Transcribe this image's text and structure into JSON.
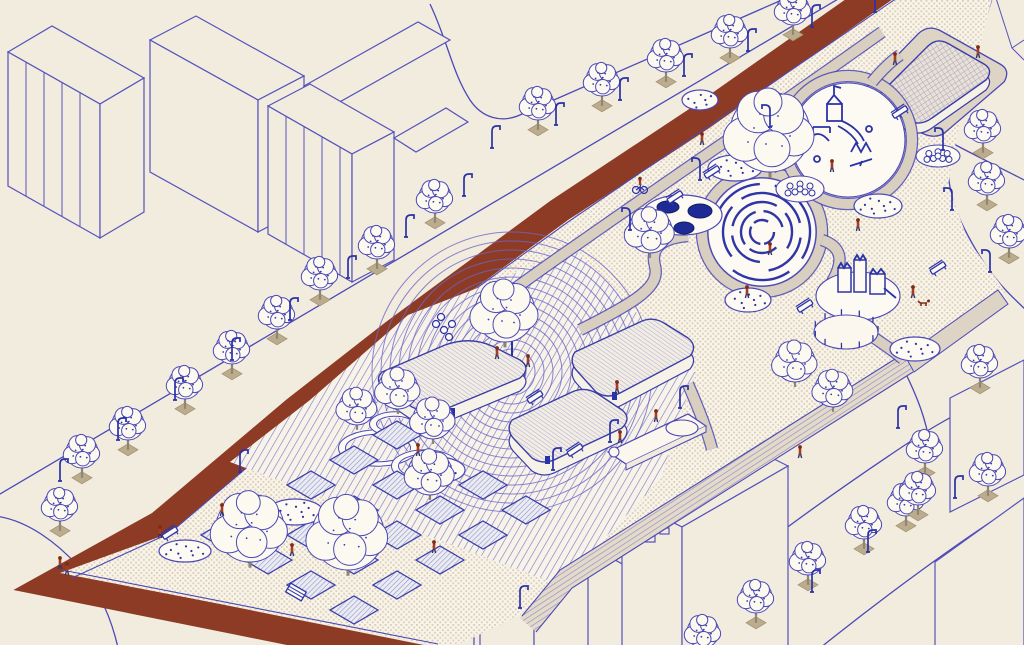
{
  "palette": {
    "background": "#f2ecdf",
    "park_ground": "#f9f4e9",
    "ground_dot": "#d9ccb6",
    "line_blue": "#4c49b6",
    "detail_navy": "#2a32a8",
    "pond_navy": "#1e2a96",
    "road_red": "#8e3b26",
    "path_tan": "#d9cfc0",
    "platform_tan": "#ded4c5",
    "person_red": "#a63c21",
    "person_head": "#7c2d16",
    "person_legs": "#2f3366",
    "tree_pit": "#bcac8e",
    "trunk": "#8f8574",
    "shape_white": "#fdfaf3",
    "wall_cream": "#f7f2e8"
  },
  "scene": {
    "plaza_rings": {
      "cx": 512,
      "cy": 372,
      "inner_r": 14,
      "step": 9,
      "count": 15
    },
    "maze": {
      "cx": 762,
      "cy": 232,
      "platform_r": 54,
      "ring_radii": [
        12,
        21,
        30,
        39,
        48
      ]
    },
    "dog_run": {
      "cx": 846,
      "cy": 332,
      "rx": 32,
      "ry": 17,
      "posts": 11
    },
    "garden_beds": {
      "origin": [
        225,
        535
      ],
      "e1": [
        43,
        -25
      ],
      "e2": [
        43,
        25
      ],
      "cols": 5,
      "rows": 4,
      "skip": [
        [
          1,
          0
        ],
        [
          4,
          1
        ]
      ]
    },
    "street_trees": [
      [
        538,
        104
      ],
      [
        602,
        80
      ],
      [
        666,
        56
      ],
      [
        730,
        32
      ],
      [
        793,
        9
      ],
      [
        82,
        452
      ],
      [
        128,
        424
      ],
      [
        185,
        383
      ],
      [
        232,
        348
      ],
      [
        277,
        313
      ],
      [
        320,
        274
      ],
      [
        377,
        243
      ],
      [
        435,
        197
      ],
      [
        60,
        505
      ],
      [
        983,
        127
      ],
      [
        987,
        179
      ],
      [
        1009,
        232
      ],
      [
        980,
        362
      ],
      [
        925,
        447
      ],
      [
        988,
        470
      ],
      [
        906,
        500
      ],
      [
        756,
        597
      ],
      [
        808,
        559
      ],
      [
        864,
        523
      ],
      [
        918,
        489
      ],
      [
        703,
        632
      ]
    ],
    "park_trees": [
      [
        770,
        132,
        40
      ],
      [
        650,
        231,
        22
      ],
      [
        505,
        312,
        30
      ],
      [
        398,
        389,
        20
      ],
      [
        357,
        407,
        18
      ],
      [
        433,
        419,
        20
      ],
      [
        250,
        528,
        34
      ],
      [
        348,
        534,
        36
      ],
      [
        430,
        473,
        22
      ],
      [
        795,
        362,
        20
      ],
      [
        833,
        389,
        18
      ]
    ],
    "lamps": [
      [
        492,
        148,
        1
      ],
      [
        556,
        125,
        1
      ],
      [
        620,
        100,
        1
      ],
      [
        684,
        76,
        1
      ],
      [
        748,
        51,
        1
      ],
      [
        812,
        27,
        1
      ],
      [
        60,
        481,
        1
      ],
      [
        118,
        440,
        1
      ],
      [
        175,
        400,
        1
      ],
      [
        232,
        360,
        1
      ],
      [
        290,
        320,
        1
      ],
      [
        348,
        278,
        1
      ],
      [
        406,
        237,
        1
      ],
      [
        464,
        196,
        1
      ],
      [
        630,
        230,
        -1
      ],
      [
        700,
        180,
        -1
      ],
      [
        770,
        127,
        -1
      ],
      [
        553,
        470,
        1
      ],
      [
        610,
        442,
        1
      ],
      [
        680,
        408,
        1
      ],
      [
        898,
        428,
        1
      ],
      [
        955,
        498,
        1
      ],
      [
        868,
        552,
        1
      ],
      [
        943,
        150,
        -1
      ],
      [
        952,
        210,
        -1
      ],
      [
        990,
        272,
        -1
      ],
      [
        240,
        472,
        1
      ],
      [
        875,
        12,
        -1
      ],
      [
        520,
        608,
        1
      ],
      [
        812,
        592,
        1
      ]
    ],
    "benches": [
      [
        712,
        172
      ],
      [
        675,
        197
      ],
      [
        805,
        306
      ],
      [
        938,
        268
      ],
      [
        900,
        112
      ],
      [
        535,
        397
      ],
      [
        575,
        450
      ],
      [
        170,
        533
      ]
    ],
    "tables": [
      [
        360,
        545
      ],
      [
        296,
        592
      ]
    ],
    "people": [
      [
        895,
        65
      ],
      [
        978,
        58
      ],
      [
        702,
        145
      ],
      [
        770,
        255
      ],
      [
        747,
        298
      ],
      [
        858,
        231
      ],
      [
        913,
        298
      ],
      [
        832,
        172
      ],
      [
        497,
        359
      ],
      [
        528,
        367
      ],
      [
        418,
        456
      ],
      [
        292,
        556
      ],
      [
        222,
        516
      ],
      [
        434,
        553
      ],
      [
        60,
        569
      ],
      [
        67,
        575
      ],
      [
        160,
        538
      ],
      [
        617,
        393
      ],
      [
        656,
        422
      ],
      [
        620,
        443
      ],
      [
        800,
        458
      ]
    ],
    "dog": [
      924,
      305
    ],
    "cyclist": [
      640,
      190
    ],
    "mounds": [
      [
        735,
        168,
        27,
        13
      ],
      [
        878,
        206,
        24,
        12
      ],
      [
        748,
        300,
        23,
        12
      ],
      [
        915,
        349,
        25,
        12
      ],
      [
        700,
        100,
        18,
        10
      ],
      [
        295,
        512,
        28,
        13
      ],
      [
        185,
        551,
        26,
        11
      ],
      [
        437,
        470,
        28,
        13
      ]
    ],
    "bump_pads": [
      [
        800,
        189,
        24,
        13
      ],
      [
        938,
        156,
        22,
        11
      ]
    ],
    "ponds": {
      "blob": [
        682,
        215,
        40,
        20
      ],
      "pools": [
        [
          668,
          207,
          11,
          6
        ],
        [
          700,
          211,
          12,
          7
        ],
        [
          684,
          228,
          10,
          6
        ]
      ]
    },
    "white_rings": [
      [
        378,
        448,
        36,
        16
      ],
      [
        425,
        466,
        30,
        14
      ],
      [
        395,
        424,
        22,
        10
      ]
    ],
    "bike_rack": [
      [
        436,
        324
      ],
      [
        444,
        330
      ],
      [
        452,
        324
      ],
      [
        441,
        317
      ],
      [
        449,
        337
      ]
    ]
  }
}
